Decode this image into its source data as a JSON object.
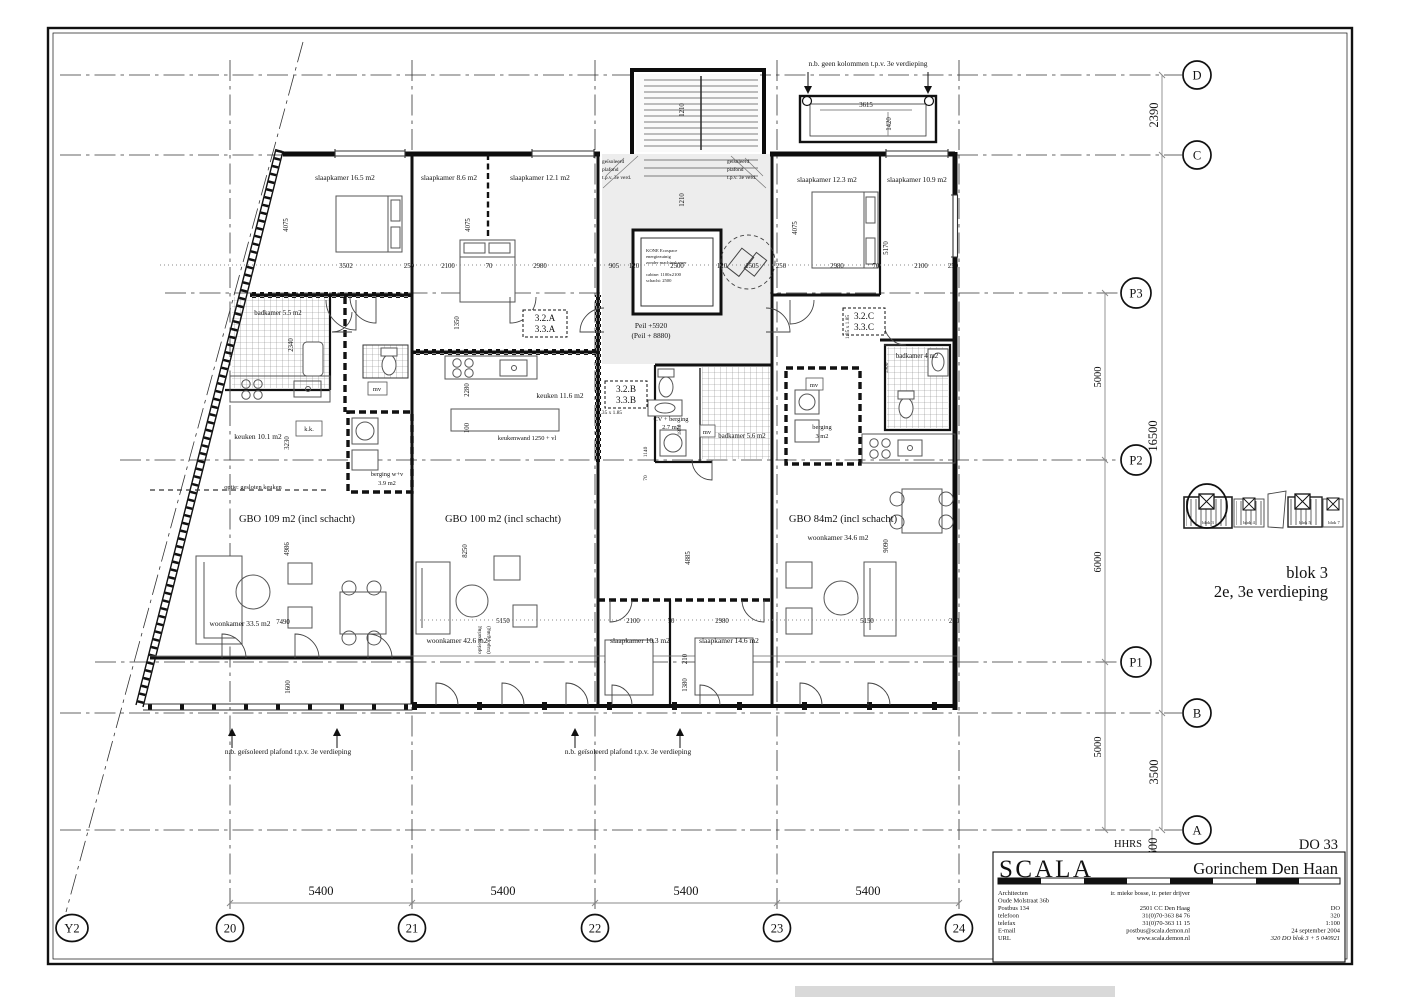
{
  "sheet": {
    "drawing_no": "DO 33",
    "project_name": "Gorinchem Den Haan",
    "block_title": "blok 3",
    "floor_title": "2e, 3e verdieping",
    "hhrs": "HHRS"
  },
  "firm": {
    "name": "SCALA",
    "architecten_label": "Architecten",
    "architects": "ir. mieke bosse, ir. peter drijver",
    "address_street": "Oude Molstraat 36b",
    "address_po": "Postbus 134",
    "address_city": "2501 CC Den Haag",
    "phone_label": "telefoon",
    "phone": "31(0)70-363 84 76",
    "fax_label": "telefax",
    "fax": "31(0)70-363 11 15",
    "email_label": "E-mail",
    "email": "postbus@scala.demon.nl",
    "url_label": "URL",
    "url": "www.scala.demon.nl",
    "doc_type": "DO",
    "doc_num": "320",
    "scale": "1:100",
    "date": "24 september 2004",
    "file_ref": "320 DO blok 3 + 5 040921"
  },
  "grid": {
    "c_y2": "Y2",
    "c20": "20",
    "c21": "21",
    "c22": "22",
    "c23": "23",
    "c24": "24",
    "r_a": "A",
    "r_b": "B",
    "r_c": "C",
    "r_d": "D",
    "r_p1": "P1",
    "r_p2": "P2",
    "r_p3": "P3"
  },
  "dims": {
    "d5400": "5400",
    "d2390": "2390",
    "d16500": "16500",
    "d5000": "5000",
    "d6000": "6000",
    "d3500": "3500",
    "d600": "600",
    "d3615": "3615",
    "d1420": "1420",
    "d1210": "1210",
    "d3502": "3502",
    "d2100": "2100",
    "d2980": "2980",
    "d905": "905",
    "d120": "120",
    "d2500": "2500",
    "d1505": "1505",
    "d250": "250",
    "d70": "70",
    "d4075": "4075",
    "d5170": "5170",
    "d2340": "2340",
    "d3230": "3230",
    "d1350": "1350",
    "d2280": "2280",
    "d100": "100",
    "d1850": "1850",
    "d1140": "1140",
    "d1900": "1900",
    "d4986": "4986",
    "d7490": "7490",
    "d8250": "8250",
    "d5150": "5150",
    "d4885": "4885",
    "d9090": "9090",
    "d1380": "1380",
    "d210": "210",
    "d1600": "1600"
  },
  "rooms": {
    "sk165": "slaapkamer 16.5 m2",
    "sk86": "slaapkamer 8.6 m2",
    "sk121": "slaapkamer 12.1 m2",
    "sk123": "slaapkamer 12.3 m2",
    "sk109": "slaapkamer 10.9 m2",
    "sk103": "slaapkamer 10.3 m2",
    "sk146": "slaapkamer 14.6 m2",
    "bad55": "badkamer 5.5 m2",
    "bad56": "badkamer 5.6 m2",
    "bad4": "badkamer 4 m2",
    "keuk101": "keuken 10.1 m2",
    "keuk116": "keuken 11.6 m2",
    "keukenwand": "keukenwand 1250 + vl",
    "woon335": "woonkamer 33.5 m2",
    "woon426": "woonkamer 42.6 m2",
    "woon346": "woonkamer 34.6 m2",
    "berg39a": "berging w+v",
    "berg39b": "3.9 m2",
    "berg3a": "berging",
    "berg3b": "3 m2",
    "cv1": "CV + berging",
    "cv2": "2.7 m2",
    "kk": "k.k.",
    "mv": "mv",
    "gbo109": "GBO 109 m2 (incl schacht)",
    "gbo100": "GBO 100 m2 (incl schacht)",
    "gbo84": "GBO 84m2 (incl schacht)"
  },
  "units": {
    "a1": "3.2.A",
    "a2": "3.3.A",
    "b1": "3.2.B",
    "b2": "3.3.B",
    "c1": "3.2.C",
    "c2": "3.3.C"
  },
  "notes": {
    "no_columns": "n.b. geen kolommen t.p.v. 3e  verdieping",
    "insulated_ceiling": "n.b. geïsoleerd plafond t.p.v. 3e  verdieping",
    "iso1": "geïsoleerd",
    "iso2": "plafond",
    "iso3": "t.p.v. 3e verd.",
    "peil": "Peil +5920",
    "peil2": "(Peil + 8880)",
    "lift1": "KONE Ecospace",
    "lift2": "energiezuinig",
    "lift3": "zonder machinekamer",
    "lift4": "cabine: 1100x2100",
    "lift5": "schacht: 2500",
    "opt_kitchen": "optie: gesloten keuken",
    "opt_sparing": "optie sparing",
    "opt_sparing2": "(trapopgang)",
    "turn": "1.35 x 1.85"
  },
  "keyplan": {
    "b3": "blok 3",
    "b4": "blok 4",
    "b5": "blok 5",
    "b7": "blok 7"
  }
}
